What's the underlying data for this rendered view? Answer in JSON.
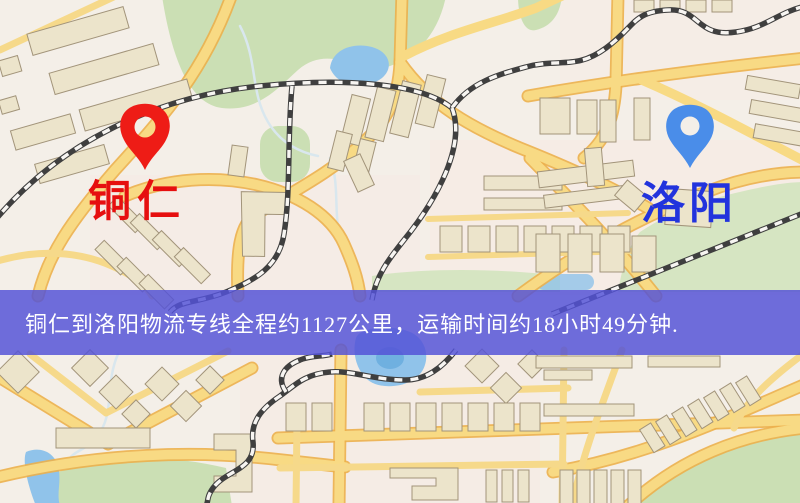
{
  "banner": {
    "text": "铜仁到洛阳物流专线全程约1127公里，运输时间约18小时49分钟.",
    "background_color": "#5452d6",
    "text_color": "#ffffff"
  },
  "markers": {
    "origin": {
      "label": "铜仁",
      "label_color": "#e60f0f",
      "pin_color": "#ee1c16",
      "pin_icon": "map-pin-icon"
    },
    "destination": {
      "label": "洛阳",
      "label_color": "#2233dd",
      "pin_color": "#4a8de9",
      "pin_icon": "map-pin-icon"
    }
  },
  "map": {
    "type": "stylized street map",
    "colors": {
      "background": "#f4efe8",
      "road_fill": "#f8da84",
      "road_casing": "#ecb04b",
      "park": "#cbdfb4",
      "water": "#90c3ea",
      "building": "#ece4cb",
      "building_outline": "#a2947a",
      "railway": "#3f3f3f"
    }
  }
}
